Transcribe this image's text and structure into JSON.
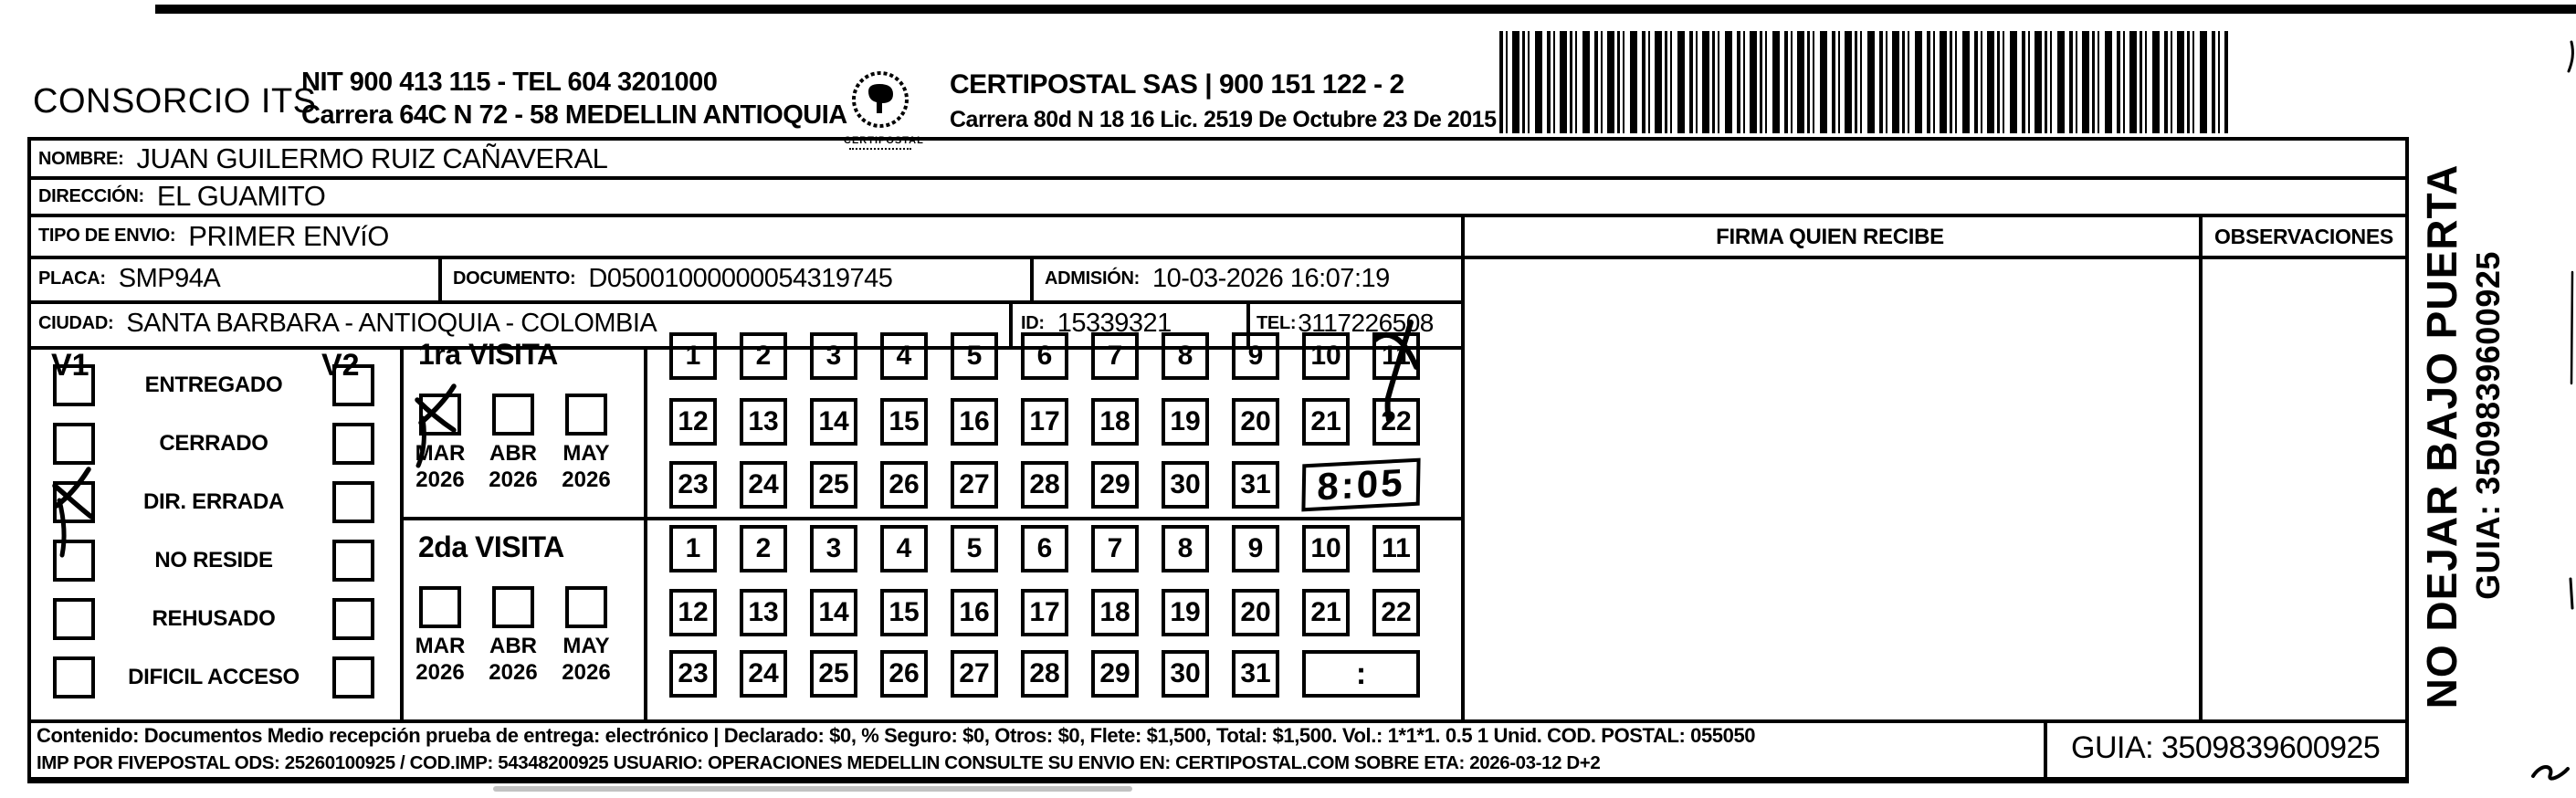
{
  "header": {
    "company_name": "CONSORCIO ITS",
    "company_info_line1": "NIT 900 413 115 - TEL 604 3201000",
    "company_info_line2": "Carrera 64C N 72 - 58 MEDELLIN ANTIOQUIA",
    "logo_caption": "CERTIPOSTAL",
    "provider_line1": "CERTIPOSTAL SAS | 900 151 122 - 2",
    "provider_line2": "Carrera 80d N 18 16  Lic. 2519 De Octubre 23 De 2015"
  },
  "recipient": {
    "name_label": "NOMBRE:",
    "name": "JUAN GUILERMO RUIZ CAÑAVERAL",
    "address_label": "DIRECCIÓN:",
    "address": "EL GUAMITO",
    "type_label": "TIPO DE ENVIO:",
    "type": "PRIMER ENVíO",
    "placa_label": "PLACA:",
    "placa": "SMP94A",
    "documento_label": "DOCUMENTO:",
    "documento": "D05001000000054319745",
    "admision_label": "ADMISIÓN:",
    "admision": "10-03-2026 16:07:19",
    "ciudad_label": "CIUDAD:",
    "ciudad": "SANTA BARBARA - ANTIOQUIA - COLOMBIA",
    "id_label": "ID:",
    "id_value": "15339321",
    "tel_label": "TEL:",
    "tel": "3117226508"
  },
  "columns": {
    "firma": "FIRMA QUIEN RECIBE",
    "observaciones": "OBSERVACIONES"
  },
  "status": {
    "v1_header": "V1",
    "v2_header": "V2",
    "options": [
      "ENTREGADO",
      "CERRADO",
      "DIR. ERRADA",
      "NO RESIDE",
      "REHUSADO",
      "DIFICIL ACCESO"
    ],
    "v1_checked": [
      false,
      false,
      true,
      false,
      false,
      false
    ],
    "v2_checked": [
      false,
      false,
      false,
      false,
      false,
      false
    ]
  },
  "visits": {
    "first": {
      "title": "1ra VISITA",
      "months": [
        "MAR",
        "ABR",
        "MAY"
      ],
      "years": [
        "2026",
        "2026",
        "2026"
      ],
      "checked_month": "MAR",
      "marked_day": "11",
      "time": "8:05"
    },
    "second": {
      "title": "2da VISITA",
      "months": [
        "MAR",
        "ABR",
        "MAY"
      ],
      "years": [
        "2026",
        "2026",
        "2026"
      ],
      "checked_month": "",
      "marked_day": "",
      "time": ":"
    }
  },
  "day_grid": [
    "1",
    "2",
    "3",
    "4",
    "5",
    "6",
    "7",
    "8",
    "9",
    "10",
    "11",
    "12",
    "13",
    "14",
    "15",
    "16",
    "17",
    "18",
    "19",
    "20",
    "21",
    "22",
    "23",
    "24",
    "25",
    "26",
    "27",
    "28",
    "29",
    "30",
    "31"
  ],
  "side": {
    "warning": "NO DEJAR BAJO PUERTA",
    "guia": "GUIA: 3509839600925"
  },
  "footer": {
    "line1": "Contenido: Documentos Medio recepción prueba de entrega: electrónico | Declarado: $0, % Seguro: $0, Otros: $0, Flete: $1,500, Total: $1,500. Vol.: 1*1*1. 0.5  1 Unid. COD. POSTAL: 055050",
    "line2": "IMP POR FIVEPOSTAL ODS: 25260100925 / COD.IMP: 54348200925 USUARIO: OPERACIONES MEDELLIN CONSULTE SU ENVIO EN: CERTIPOSTAL.COM SOBRE ETA: 2026-03-12 D+2",
    "guia": "GUIA: 3509839600925"
  }
}
